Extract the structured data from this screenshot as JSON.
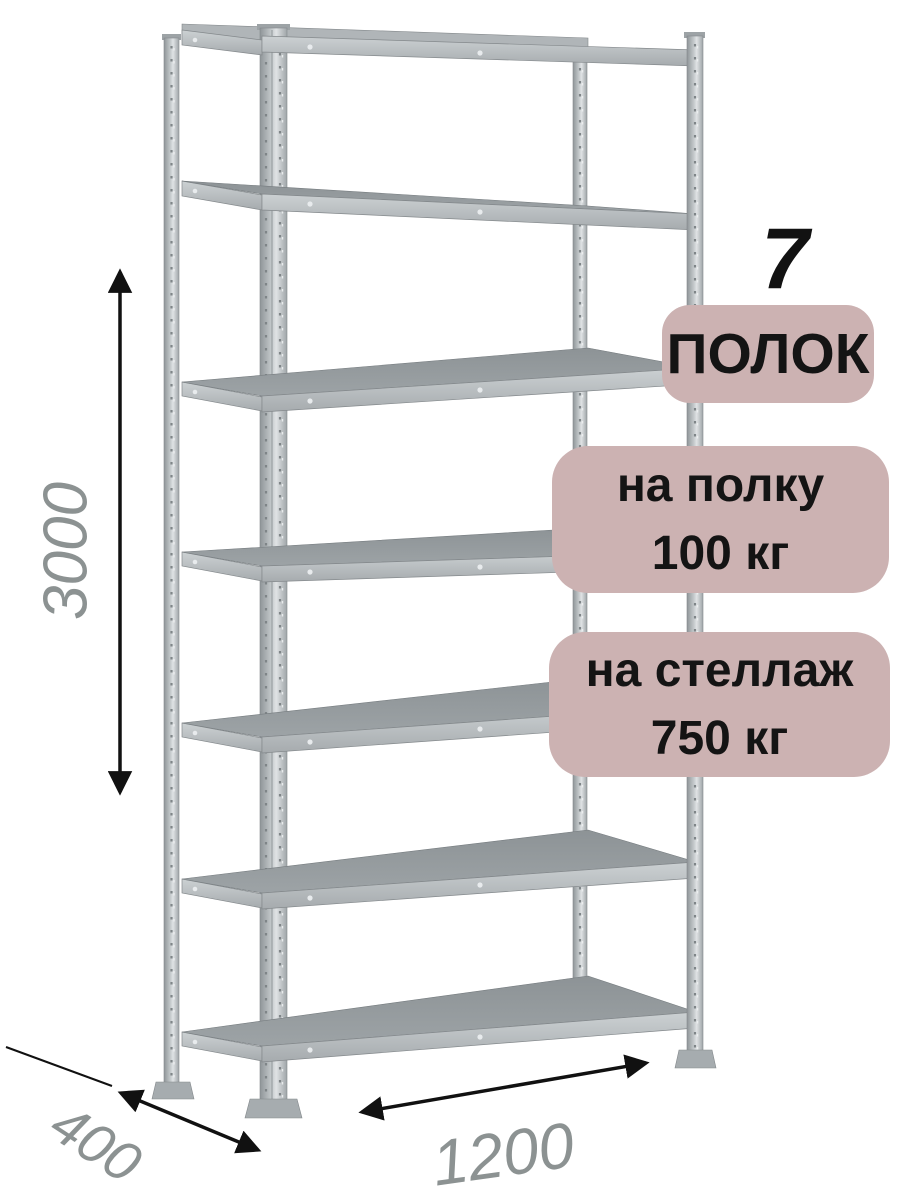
{
  "product_card": {
    "description": "Metal boltless shelving rack, 7 shelves, isometric product render with dimension callouts",
    "shelf_count": {
      "number": "7",
      "label": "ПОЛОК"
    },
    "capacity_badges": [
      {
        "line1": "на полку",
        "line2": "100 кг"
      },
      {
        "line1": "на стеллаж",
        "line2": "750 кг"
      }
    ],
    "dimensions": {
      "height": "3000",
      "depth": "400",
      "width": "1200"
    },
    "colors": {
      "badge_background": "#ccb2b2",
      "badge_text": "#141414",
      "dimension_text": "#8c9292",
      "dimension_arrow": "#111111",
      "metal_light": "#c7ccce",
      "metal_mid": "#a9aeb1",
      "metal_dark": "#8f9598",
      "background": "#ffffff"
    }
  }
}
